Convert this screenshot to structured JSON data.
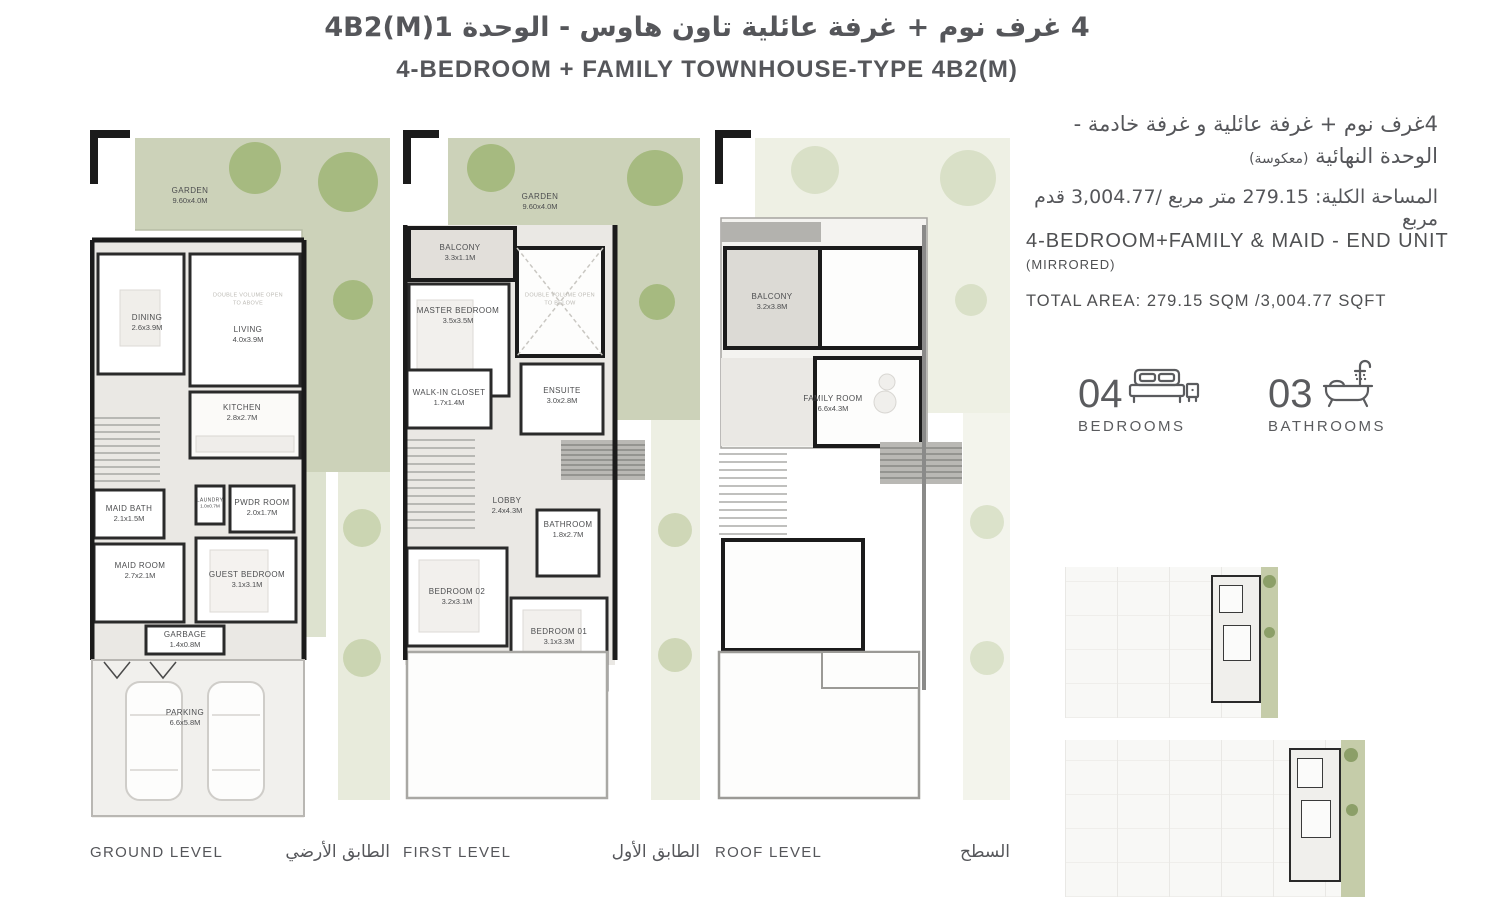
{
  "header": {
    "title_ar": "4 غرف نوم + غرفة عائلية تاون هاوس - الوحدة 4B2(M)1",
    "title_en": "4-BEDROOM + FAMILY TOWNHOUSE-TYPE 4B2(M)"
  },
  "info_panel": {
    "desc_ar_line1": "4غرف نوم + غرفة عائلية و غرفة خادمة -",
    "desc_ar_line2": "الوحدة النهائية",
    "desc_ar_note": "(معكوسة)",
    "area_ar": "المساحة الكلية: 279.15 متر مربع /3,004.77 قدم مربع",
    "heading_en": "4-BEDROOM+FAMILY & MAID - END UNIT",
    "mirrored": "(MIRRORED)",
    "total_area_en": "TOTAL AREA: 279.15 SQM /3,004.77 SQFT",
    "stats": [
      {
        "count": "04",
        "label": "BEDROOMS",
        "icon": "bed-icon"
      },
      {
        "count": "03",
        "label": "BATHROOMS",
        "icon": "bathtub-icon"
      }
    ]
  },
  "plans": [
    {
      "id": "ground-level",
      "caption_en": "GROUND LEVEL",
      "caption_ar": "الطابق الأرضي",
      "note": "DOUBLE VOLUME OPEN TO ABOVE",
      "rooms": [
        {
          "name": "GARDEN",
          "dim": "9.60x4.0M"
        },
        {
          "name": "DINING",
          "dim": "2.6x3.9M"
        },
        {
          "name": "LIVING",
          "dim": "4.0x3.9M"
        },
        {
          "name": "KITCHEN",
          "dim": "2.8x2.7M"
        },
        {
          "name": "LAUNDRY",
          "dim": "1.0x0.7M"
        },
        {
          "name": "PWDR ROOM",
          "dim": "2.0x1.7M"
        },
        {
          "name": "MAID BATH",
          "dim": "2.1x1.5M"
        },
        {
          "name": "MAID ROOM",
          "dim": "2.7x2.1M"
        },
        {
          "name": "GUEST BEDROOM",
          "dim": "3.1x3.1M"
        },
        {
          "name": "GARBAGE",
          "dim": "1.4x0.8M"
        },
        {
          "name": "PARKING",
          "dim": "6.6x5.8M"
        }
      ]
    },
    {
      "id": "first-level",
      "caption_en": "FIRST LEVEL",
      "caption_ar": "الطابق الأول",
      "note": "DOUBLE VOLUME OPEN TO BELOW",
      "rooms": [
        {
          "name": "GARDEN",
          "dim": "9.60x4.0M"
        },
        {
          "name": "BALCONY",
          "dim": "3.3x1.1M"
        },
        {
          "name": "MASTER BEDROOM",
          "dim": "3.5x3.5M"
        },
        {
          "name": "WALK-IN CLOSET",
          "dim": "1.7x1.4M"
        },
        {
          "name": "ENSUITE",
          "dim": "3.0x2.8M"
        },
        {
          "name": "LOBBY",
          "dim": "2.4x4.3M"
        },
        {
          "name": "BATHROOM",
          "dim": "1.8x2.7M"
        },
        {
          "name": "BEDROOM 02",
          "dim": "3.2x3.1M"
        },
        {
          "name": "BEDROOM 01",
          "dim": "3.1x3.3M"
        }
      ]
    },
    {
      "id": "roof-level",
      "caption_en": "ROOF LEVEL",
      "caption_ar": "السطح",
      "rooms": [
        {
          "name": "BALCONY",
          "dim": "3.2x3.8M"
        },
        {
          "name": "FAMILY ROOM",
          "dim": "6.6x4.3M"
        }
      ]
    }
  ],
  "colors": {
    "garden_green": "#ccd2b9",
    "tree_green": "#a6ba80",
    "wall_black": "#1b1b1b",
    "wall_gray": "#8a8a89",
    "floor_gray": "#eae8e4",
    "text_gray": "#58595b"
  }
}
